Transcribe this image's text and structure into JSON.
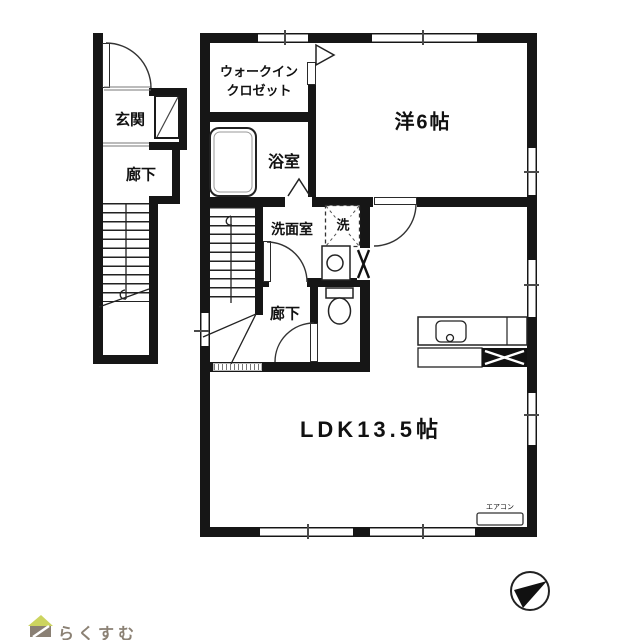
{
  "rooms": {
    "genkan": "玄関",
    "rouka_1f": "廊下",
    "wic_line1": "ウォークイン",
    "wic_line2": "クロゼット",
    "bath": "浴室",
    "senmen": "洗面室",
    "laundry": "洗",
    "rouka_2f": "廊下",
    "western_room": "洋6帖",
    "ldk": "LDK13.5帖",
    "aircon": "エアコン"
  },
  "branding": {
    "logo_text": "らくすむ"
  },
  "colors": {
    "wall": "#161616",
    "window_line": "#8f8f8f",
    "logo_text": "#8b8174",
    "logo_roof": "#ccd45f",
    "logo_body": "#8a8074"
  }
}
